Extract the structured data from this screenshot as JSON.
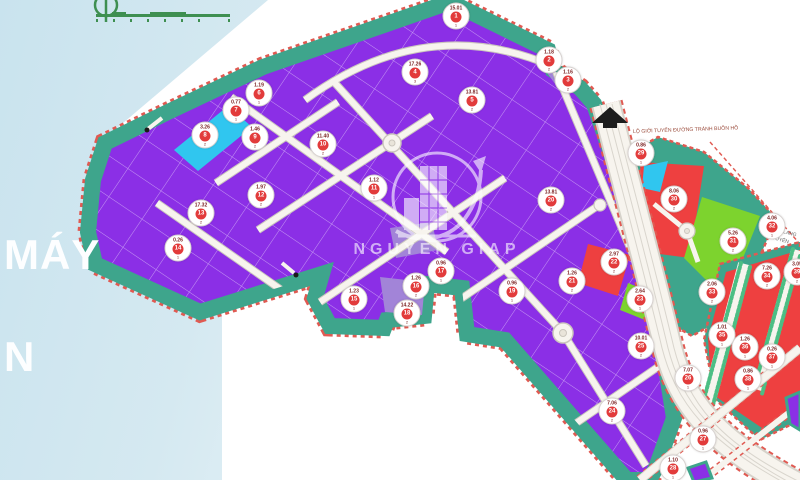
{
  "header": {
    "line1": "MÁY",
    "line2": "N"
  },
  "watermark": {
    "name": "NGUYEN GIAP",
    "logo": "buildings-growth-arrow-icon"
  },
  "map_labels": {
    "road_boundary": "LỘ GIỚI TUYẾN ĐƯỜNG TRÁNH BUÔN HỒ",
    "corridor_1": "HÀNH LANG",
    "corridor_2": "TUYẾN"
  },
  "colors": {
    "bg_blue": "#c9e3ee",
    "sheet_white": "#ffffff",
    "purple": "#8b2fe6",
    "purple_light": "#a284d8",
    "cyan": "#30c6ef",
    "teal": "#3ea58c",
    "red": "#ee4040",
    "green": "#7dd32e",
    "boundary_dash": "#e05a52",
    "road_fill": "#f7f4ee",
    "road_casing": "#cbc6bd",
    "strip_green": "#4cbe84",
    "badge_red": "#e23b3b",
    "scalebar_green": "#3e8f51",
    "watermark_white": "#ffffff"
  },
  "badges": [
    {
      "x": 456,
      "y": 16,
      "area": "15.01",
      "lot": "1",
      "sub": "1"
    },
    {
      "x": 549,
      "y": 60,
      "area": "1.18",
      "lot": "2",
      "sub": "2"
    },
    {
      "x": 568,
      "y": 80,
      "area": "1.16",
      "lot": "3",
      "sub": "2"
    },
    {
      "x": 415,
      "y": 72,
      "area": "17.26",
      "lot": "4",
      "sub": "3"
    },
    {
      "x": 472,
      "y": 100,
      "area": "13.81",
      "lot": "5",
      "sub": "2"
    },
    {
      "x": 259,
      "y": 93,
      "area": "1.19",
      "lot": "6",
      "sub": "1"
    },
    {
      "x": 236,
      "y": 110,
      "area": "0.77",
      "lot": "7",
      "sub": "1"
    },
    {
      "x": 205,
      "y": 135,
      "area": "3.26",
      "lot": "8",
      "sub": "2"
    },
    {
      "x": 255,
      "y": 137,
      "area": "1.46",
      "lot": "9",
      "sub": "2"
    },
    {
      "x": 323,
      "y": 144,
      "area": "11.40",
      "lot": "10",
      "sub": "2"
    },
    {
      "x": 374,
      "y": 188,
      "area": "1.12",
      "lot": "11",
      "sub": "1"
    },
    {
      "x": 261,
      "y": 195,
      "area": "1.97",
      "lot": "12",
      "sub": "2"
    },
    {
      "x": 201,
      "y": 213,
      "area": "17.32",
      "lot": "13",
      "sub": "2"
    },
    {
      "x": 178,
      "y": 248,
      "area": "0.26",
      "lot": "14",
      "sub": "1"
    },
    {
      "x": 354,
      "y": 299,
      "area": "1.23",
      "lot": "15",
      "sub": "1"
    },
    {
      "x": 416,
      "y": 286,
      "area": "1.26",
      "lot": "16",
      "sub": "2"
    },
    {
      "x": 441,
      "y": 271,
      "area": "0.96",
      "lot": "17",
      "sub": "1"
    },
    {
      "x": 407,
      "y": 313,
      "area": "14.22",
      "lot": "18",
      "sub": "2"
    },
    {
      "x": 512,
      "y": 291,
      "area": "0.96",
      "lot": "19",
      "sub": "1"
    },
    {
      "x": 551,
      "y": 200,
      "area": "13.81",
      "lot": "20",
      "sub": "2"
    },
    {
      "x": 572,
      "y": 281,
      "area": "1.26",
      "lot": "21",
      "sub": "2"
    },
    {
      "x": 614,
      "y": 262,
      "area": "2.97",
      "lot": "22",
      "sub": "2"
    },
    {
      "x": 640,
      "y": 299,
      "area": "2.64",
      "lot": "23",
      "sub": "1"
    },
    {
      "x": 612,
      "y": 411,
      "area": "7.06",
      "lot": "24",
      "sub": "2"
    },
    {
      "x": 641,
      "y": 346,
      "area": "10.01",
      "lot": "25",
      "sub": "2"
    },
    {
      "x": 688,
      "y": 378,
      "area": "7.07",
      "lot": "26",
      "sub": "1"
    },
    {
      "x": 703,
      "y": 439,
      "area": "0.96",
      "lot": "27",
      "sub": "1"
    },
    {
      "x": 673,
      "y": 468,
      "area": "1.10",
      "lot": "28",
      "sub": "1"
    },
    {
      "x": 641,
      "y": 153,
      "area": "0.86",
      "lot": "29",
      "sub": "1"
    },
    {
      "x": 674,
      "y": 199,
      "area": "8.06",
      "lot": "30",
      "sub": "2"
    },
    {
      "x": 733,
      "y": 241,
      "area": "5.26",
      "lot": "31",
      "sub": "2"
    },
    {
      "x": 772,
      "y": 226,
      "area": "4.06",
      "lot": "32",
      "sub": "1"
    },
    {
      "x": 712,
      "y": 292,
      "area": "2.06",
      "lot": "33",
      "sub": "2"
    },
    {
      "x": 767,
      "y": 276,
      "area": "7.26",
      "lot": "34",
      "sub": "2"
    },
    {
      "x": 722,
      "y": 335,
      "area": "1.01",
      "lot": "35",
      "sub": "1"
    },
    {
      "x": 745,
      "y": 347,
      "area": "1.26",
      "lot": "36",
      "sub": "1"
    },
    {
      "x": 772,
      "y": 357,
      "area": "0.26",
      "lot": "37",
      "sub": "1"
    },
    {
      "x": 748,
      "y": 379,
      "area": "0.86",
      "lot": "38",
      "sub": "1"
    },
    {
      "x": 797,
      "y": 272,
      "area": "3.05",
      "lot": "39",
      "sub": "2"
    }
  ]
}
